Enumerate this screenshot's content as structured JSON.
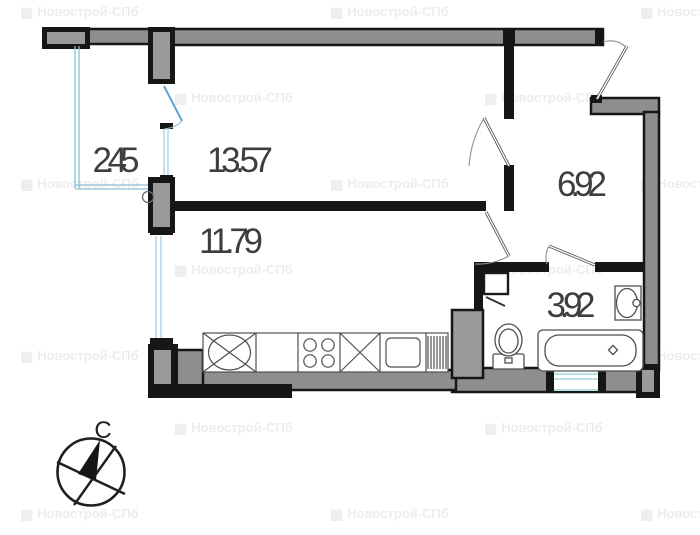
{
  "plan": {
    "rooms": [
      {
        "id": "balcony",
        "area": "2.45"
      },
      {
        "id": "living-room",
        "area": "13.57"
      },
      {
        "id": "kitchen-living",
        "area": "11.79"
      },
      {
        "id": "hallway",
        "area": "6.92"
      },
      {
        "id": "bathroom",
        "area": "3.92"
      }
    ]
  },
  "compass": {
    "north_label": "С"
  },
  "watermark": {
    "icon": "▦",
    "text": "Новострой-СПб"
  },
  "colors": {
    "wall_core": "#8e8e8e",
    "wall_outline": "#161616",
    "window_glazing": "#a8d2e6",
    "balcony_door": "#5aa7cf",
    "label_text": "#3e3e3e",
    "watermark_text": "#ededed"
  }
}
